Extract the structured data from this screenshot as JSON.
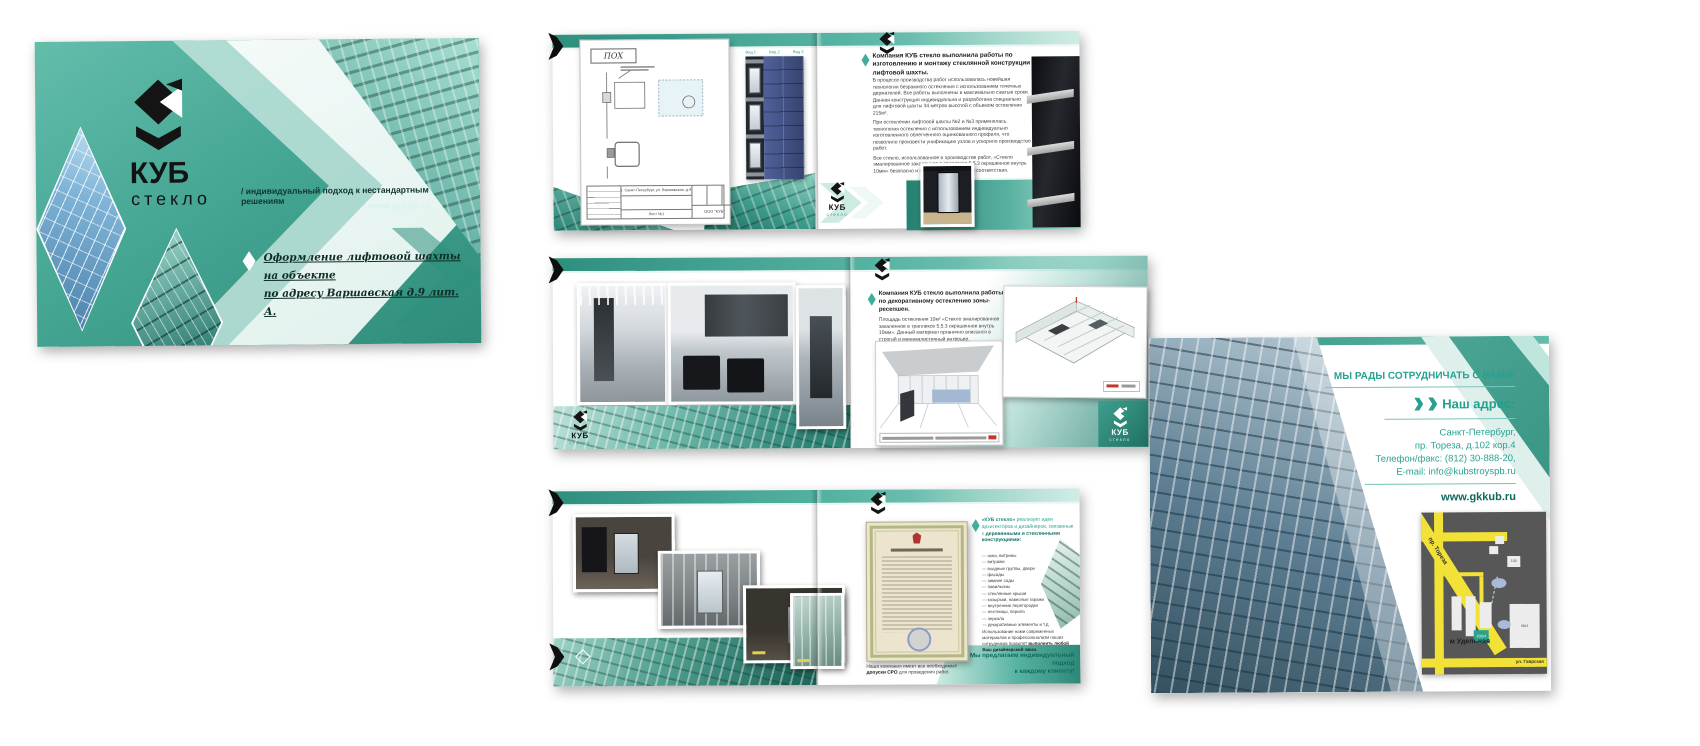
{
  "brand": {
    "name_line1": "КУБ",
    "name_line2": "стекло",
    "tagline": "/ индивидуальный подход к нестандартным решениям",
    "website": "/ www.gkkub.ru"
  },
  "cover": {
    "project_line1": "Оформление лифтовой шахты на объекте",
    "project_line2": "по адресу Варшавская д.9 лит. А."
  },
  "spread1": {
    "drawing_stamp": "ПОХ",
    "view_labels": [
      "Вид 1",
      "Вид 2",
      "Вид 3"
    ],
    "titleblock_address": "г. Санкт-Петербург, ул. Варшавская, д.9",
    "titleblock_sheet": "Лист №1",
    "titleblock_company": "ООО \"КУБ\"",
    "heading": "Компания КУБ стекло выполнила работы по изготовлению и монтажу стеклянной конструкции лифтовой шахты.",
    "paragraphs": [
      "В процессе производства работ использовалась новейшая технология безрамного остекления с использованием точечных держателей. Все работы выполнены в максимально сжатые сроки. Данная конструкция индивидуальна и разработана специально для лифтовой шахты 34 метров высотой с объемом остекления 215м².",
      "При остеклении лифтовой шахты №2 и №3 применялась технология остекления с использованием индивидуально изготовленного облегченного оцинкованного профиля, что позволило произвести унификацию узлов и ускорило производство работ.",
      "Все стекло, использованное в производстве работ, «Стекло эмалированное закаленное в триплексе 5.5.3 окрашенное внутрь 10мм» безопасно и имеет все сертификаты соответствия.",
      "Общая площадь остекления, проведенного нашей компанией на 3-х лифтовых шахтах, составляет 217м²."
    ]
  },
  "spread2": {
    "heading": "Компания КУБ стекло выполнила работы по декоративному остеклению зоны-ресепшен.",
    "body": "Площадь остекления 10м² «Стекло эмалированное закаленное в триплексе 5.5.3 окрашенное внутрь 10мм». Данный материал органично вписался в строгий и минималистичный интерьер."
  },
  "spread3": {
    "lead_brand": "«КУБ стекло» ",
    "lead_text": "реализует идеи архитекторов и дизайнеров, связанные с ",
    "lead_bold": "деревянными и стеклянными конструкциями:",
    "items": [
      "— окна, витрины",
      "— витражи",
      "— входные группы, двери",
      "— фасады",
      "— зимние сады",
      "— павильоны",
      "— стеклянные крыши",
      "— козырьки, навесные гаражи",
      "— внутренние перегородки",
      "— лестницы, перила",
      "— зеркала",
      "— декоративные элементы и т.д."
    ],
    "note_text": "Использование нами современных материалов и профессионализм наших сотрудников позволят ",
    "note_bold": "выполнить любой Ваш дизайнерский заказ.",
    "closing_line1": "Мы предлагаем индивидуальный подход",
    "closing_line2": "к каждому клиенту!",
    "sro_pre": "Наша компания имеет все необходимые ",
    "sro_bold": "допуски СРО ",
    "sro_post": "для проведения работ."
  },
  "back": {
    "title": "МЫ РАДЫ СОТРУДНИЧАТЬ С ВАМИ!",
    "address_label": "Наш адрес:",
    "address_lines": [
      "Санкт-Петербург,",
      "пр. Тореза, д.102 кор.4",
      "Телефон/факс:  (812) 30-888-20,",
      "E-mail: info@kubstroyspb.ru"
    ],
    "website": "www.gkkub.ru",
    "map": {
      "street_main": "пр. Тореза",
      "street_bottom": "ул. Гаврская",
      "metro": "м Удельная",
      "building_highlight": "102к4",
      "building_a": "98к1",
      "building_b": "100"
    }
  },
  "icons": {
    "kub_logo": "css-svg-shape",
    "diamond_bullet": "css-diamond-shape",
    "double_chevron": "css-triangle-shapes",
    "corner_arrow": "css-pentagon-shape"
  },
  "colors": {
    "teal": "#4bb09e",
    "teal_dark": "#2e8d7c",
    "teal_deep": "#156b5e",
    "mint": "#cdeae2",
    "mint_light": "#f2faf8",
    "text_dark": "#2b2b2b",
    "teal_text": "#2aa08e",
    "map_yellow": "#f2e136"
  }
}
